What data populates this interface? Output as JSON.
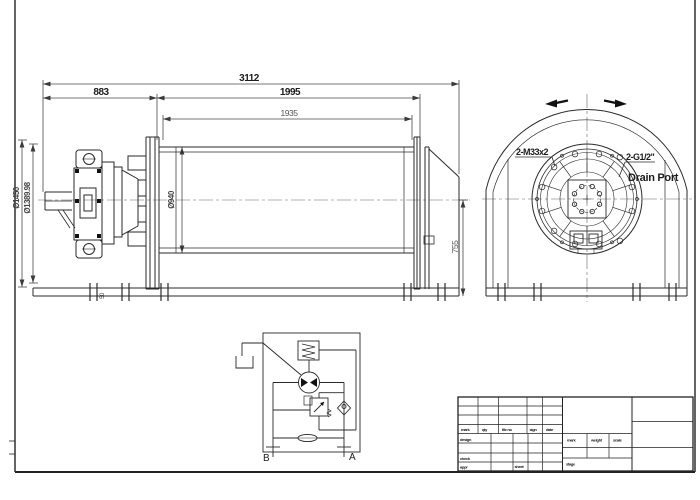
{
  "drawing": {
    "side_view": {
      "dim_overall": "3112",
      "dim_motor_section": "883",
      "dim_drum_section": "1995",
      "dim_drum_inner": "1935",
      "dim_flange_dia": "Ø1450",
      "dim_pitch_dia": "Ø1389.98",
      "dim_barrel_dia": "Ø940",
      "dim_axis_height": "755",
      "dim_base_offset": "50"
    },
    "end_view": {
      "bolt_label": "2-M33x2",
      "drain_label": "2-G1/2\"",
      "drain_sub_label": "Drain Port"
    },
    "schematic": {
      "port_b": "B",
      "port_a": "A"
    },
    "title_block": {
      "rev_headers": [
        "mark",
        "qty",
        "file no",
        "sign",
        "date"
      ],
      "left_rows": [
        "design",
        "check",
        "appr"
      ],
      "sheet_label": "sheet",
      "mid_headers": [
        "mark",
        "weight",
        "scale"
      ],
      "stage_label": "stage"
    },
    "colors": {
      "line": "#2a2a2a",
      "dim_line": "#4a4a4a",
      "background": "#ffffff"
    }
  }
}
